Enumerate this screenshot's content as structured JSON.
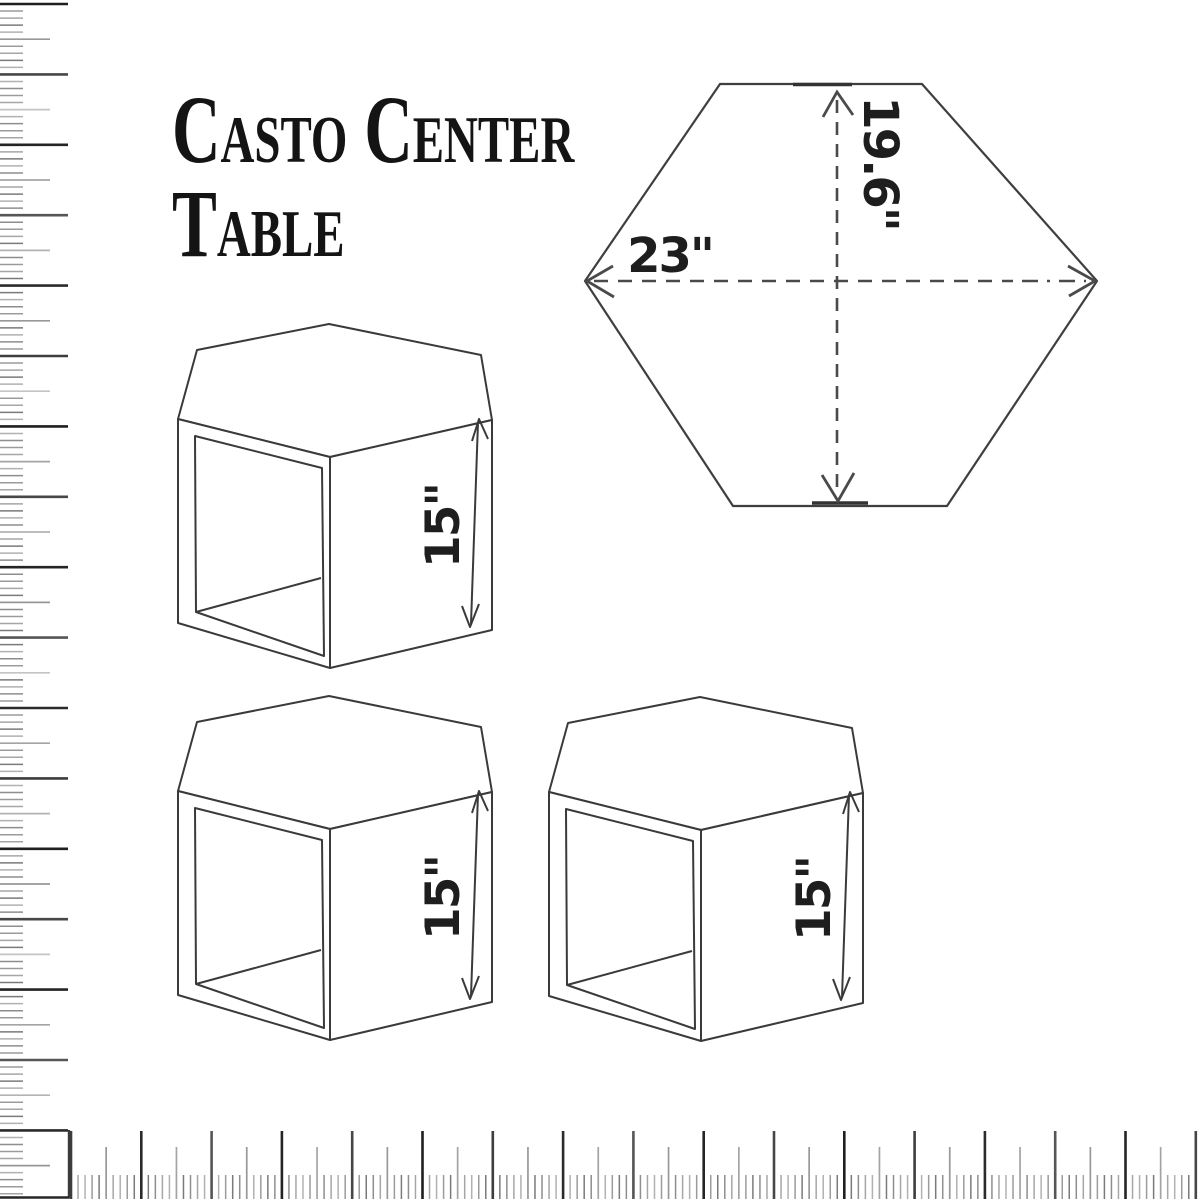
{
  "title": {
    "text": "Casto Center Table",
    "line1": "Casto Center",
    "line2": "Table",
    "color": "#141414"
  },
  "top_view": {
    "shape": "hexagon",
    "width_label": "23\"",
    "height_label": "19.6\"",
    "line_color": "#3a3a3a"
  },
  "tables": [
    {
      "view": "isometric",
      "height_label": "15\""
    },
    {
      "view": "isometric",
      "height_label": "15\""
    },
    {
      "view": "isometric",
      "height_label": "15\""
    }
  ],
  "rulers": {
    "left": {
      "orientation": "vertical",
      "divisions_per_inch": 10
    },
    "bottom": {
      "orientation": "horizontal",
      "divisions_per_inch": 10
    }
  }
}
